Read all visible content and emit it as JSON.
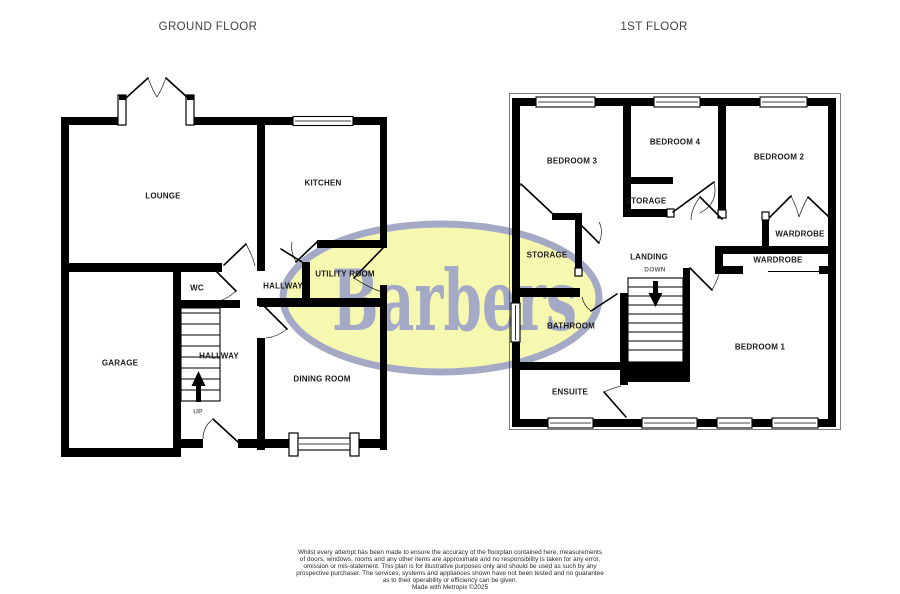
{
  "ground_floor": {
    "title": "GROUND FLOOR",
    "labels": {
      "lounge": "LOUNGE",
      "kitchen": "KITCHEN",
      "wc": "WC",
      "hallway_upper": "HALLWAY",
      "utility_room": "UTILITY ROOM",
      "garage": "GARAGE",
      "hallway_stairs": "HALLWAY",
      "up": "UP",
      "dining_room": "DINING ROOM"
    }
  },
  "first_floor": {
    "title": "1ST FLOOR",
    "labels": {
      "bedroom3": "BEDROOM 3",
      "bedroom4": "BEDROOM 4",
      "bedroom2": "BEDROOM 2",
      "storage_small": "STORAGE",
      "storage_left": "STORAGE",
      "landing": "LANDING",
      "down": "DOWN",
      "wardrobe_top": "WARDROBE",
      "wardrobe_lower": "WARDROBE",
      "bathroom": "BATHROOM",
      "bedroom1": "BEDROOM 1",
      "ensuite": "ENSUITE"
    }
  },
  "watermark": {
    "text": "Barbers",
    "fill": "#f6f8b0",
    "accent": "#a4aac6"
  },
  "colors": {
    "wall": "#000000",
    "background": "#ffffff",
    "label_text": "#1c1c1c",
    "title_text": "#404040"
  },
  "footer": {
    "lines": [
      "Whilst every attempt has been made to ensure the accuracy of the floorplan contained here, measurements",
      "of doors, windows, rooms and any other items are approximate and no responsibility is taken for any error,",
      "omission or mis-statement. This plan is for illustrative purposes only and should be used as such by any",
      "prospective purchaser. The services, systems and appliances shown have not been tested and no guarantee",
      "as to their operability or efficiency can be given.",
      "Made with Metropix ©2025"
    ]
  }
}
